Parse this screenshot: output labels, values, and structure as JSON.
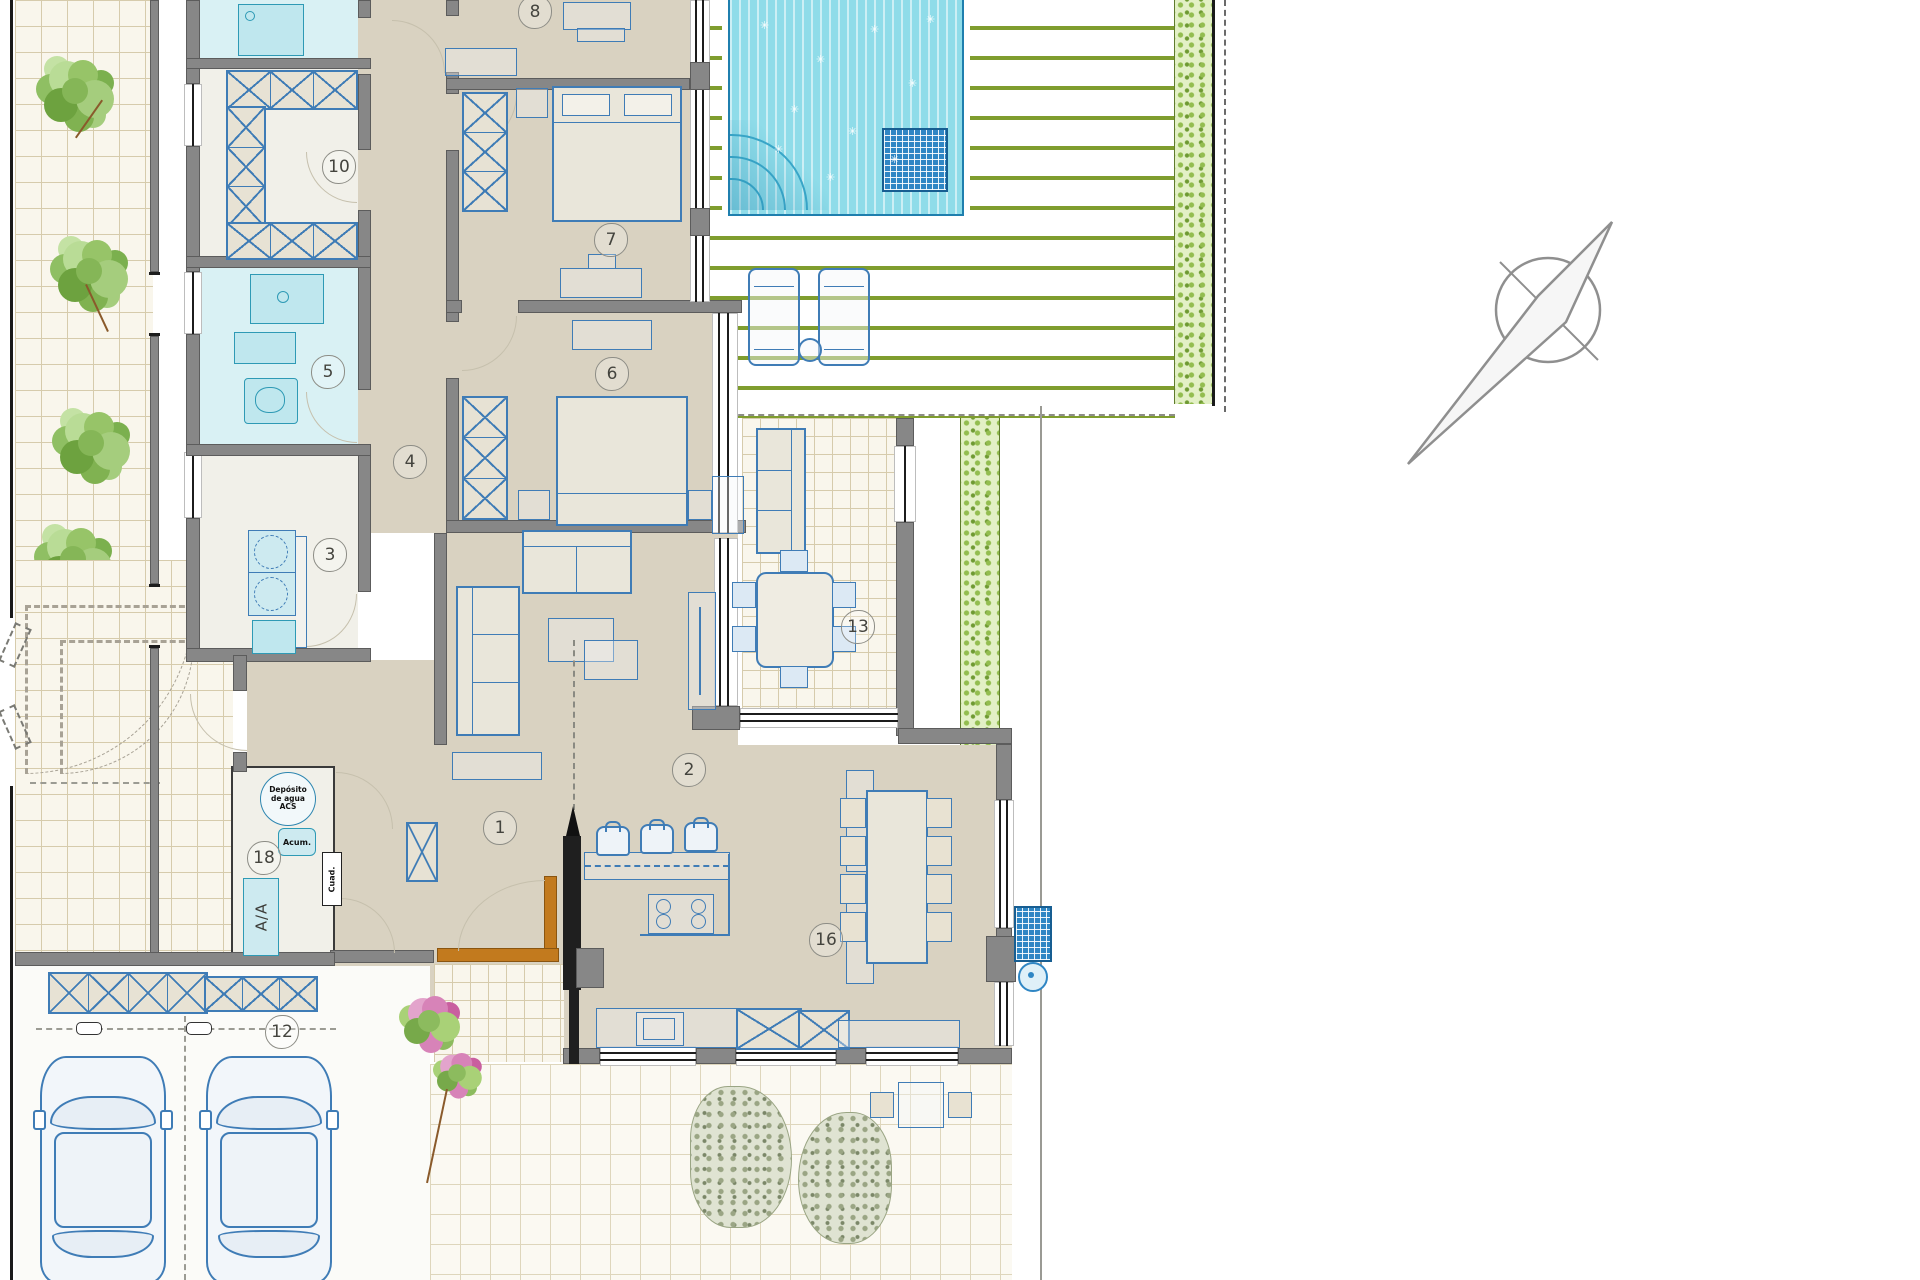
{
  "plan": {
    "type": "architectural-floor-plan",
    "units_visible_text": "none",
    "room_labels": [
      {
        "n": "1",
        "x": 500,
        "y": 828
      },
      {
        "n": "2",
        "x": 689,
        "y": 770
      },
      {
        "n": "3",
        "x": 330,
        "y": 555
      },
      {
        "n": "4",
        "x": 410,
        "y": 462
      },
      {
        "n": "5",
        "x": 328,
        "y": 372
      },
      {
        "n": "6",
        "x": 612,
        "y": 374
      },
      {
        "n": "7",
        "x": 611,
        "y": 240
      },
      {
        "n": "8",
        "x": 535,
        "y": 12
      },
      {
        "n": "10",
        "x": 339,
        "y": 167
      },
      {
        "n": "12",
        "x": 282,
        "y": 1032
      },
      {
        "n": "13",
        "x": 858,
        "y": 627
      },
      {
        "n": "16",
        "x": 826,
        "y": 940
      },
      {
        "n": "18",
        "x": 264,
        "y": 858
      }
    ],
    "annotations": {
      "deposito": "Depósito de agua ACS",
      "acum": "Acum.",
      "aa": "A/A",
      "cuad": "Cuad."
    },
    "palette": {
      "interior_floor": "#d9d2c1",
      "wall_gray": "#878787",
      "furniture_blue": "#3f7cb6",
      "pool_water": "#8fdce9",
      "pool_hatch": "#2f86c4",
      "deck_line_green": "#7f9d2e",
      "hedge_green": "#93bd4f",
      "bathroom_cyan": "#d9f1f4",
      "entry_door_orange": "#c27a1e"
    },
    "features": [
      "swimming-pool",
      "wood-deck",
      "hedge",
      "garden-trees",
      "garage-two-cars",
      "north-arrow",
      "outdoor-dining",
      "kitchen-island",
      "technical-room"
    ]
  }
}
